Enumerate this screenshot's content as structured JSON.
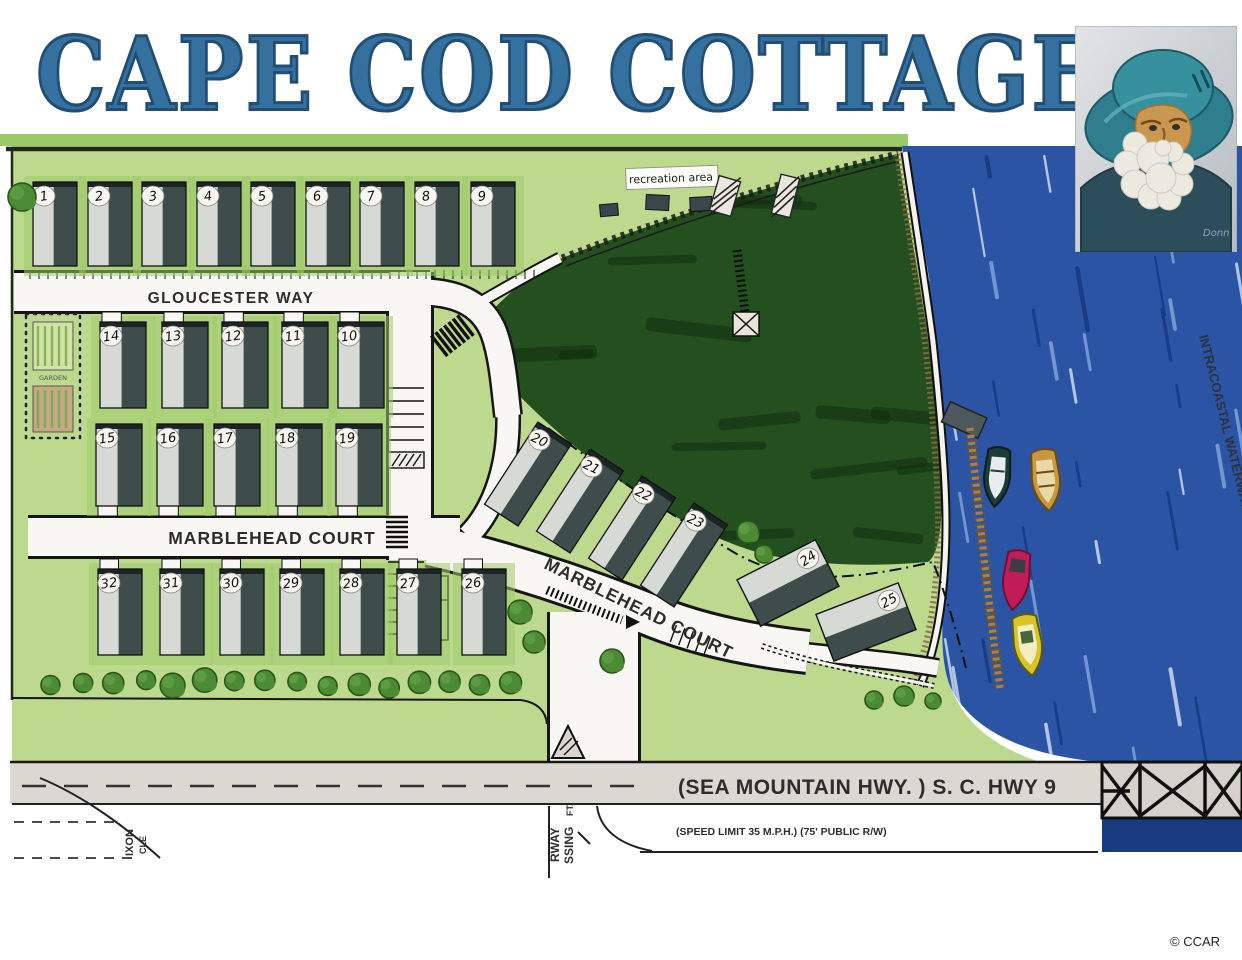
{
  "title": "CAPE COD COTTAGES",
  "credit": "© CCAR",
  "painting": {
    "signature": "Donn"
  },
  "map": {
    "labels": {
      "recreation": "recreation area",
      "gloucester": "GLOUCESTER WAY",
      "marblehead_h": "MARBLEHEAD COURT",
      "marblehead_d": "MARBLEHEAD COURT",
      "highway": "(SEA MOUNTAIN HWY. )   S. C. HWY 9",
      "speed": "(SPEED LIMIT 35 M.P.H.) (75' PUBLIC R/W)",
      "waterway": "INTRACOASTAL WATERWAY",
      "garden": "GARDEN",
      "street_left_a": "IXON",
      "street_left_b": "CLE",
      "entrance_a": "RWAY",
      "entrance_b": "SSING",
      "entrance_c": "FT."
    },
    "colors": {
      "title_blue": "#34719f",
      "site_green": "#bdd98e",
      "stripe_green": "#9fcb6c",
      "border_green": "#9cc968",
      "marsh_green": "#24501f",
      "marsh_dark": "#112e0e",
      "water_blue": "#2b54a4",
      "water_light": "#7fa2d8",
      "water_white": "#ccd8ee",
      "water_dark": "#173a80",
      "road_white": "#f8f7f3",
      "highway_gray": "#dbd8d1",
      "lot_light": "#d7d9d5",
      "lot_dark": "#3e4c4c",
      "tree_green": "#4c8a33",
      "dock_brown": "#a5814f",
      "boat_dark": "#1d3b38",
      "boat_tan": "#c9973f",
      "boat_red": "#c01d56",
      "boat_yellow": "#d9c428"
    },
    "lot_rows": [
      {
        "y": 182,
        "h": 84,
        "w": 44,
        "stub": "none",
        "ticks": true,
        "items": [
          {
            "n": "1",
            "x": 33
          },
          {
            "n": "2",
            "x": 88
          },
          {
            "n": "3",
            "x": 142
          },
          {
            "n": "4",
            "x": 197
          },
          {
            "n": "5",
            "x": 251
          },
          {
            "n": "6",
            "x": 306
          },
          {
            "n": "7",
            "x": 360
          },
          {
            "n": "8",
            "x": 415
          },
          {
            "n": "9",
            "x": 471
          }
        ]
      },
      {
        "y": 322,
        "h": 86,
        "w": 46,
        "stub": "top",
        "ticks": false,
        "items": [
          {
            "n": "14",
            "x": 100
          },
          {
            "n": "13",
            "x": 162
          },
          {
            "n": "12",
            "x": 222
          },
          {
            "n": "11",
            "x": 282
          },
          {
            "n": "10",
            "x": 338
          }
        ]
      },
      {
        "y": 424,
        "h": 82,
        "w": 46,
        "stub": "bottom",
        "ticks": false,
        "items": [
          {
            "n": "15",
            "x": 96
          },
          {
            "n": "16",
            "x": 157
          },
          {
            "n": "17",
            "x": 214
          },
          {
            "n": "18",
            "x": 276
          },
          {
            "n": "19",
            "x": 336
          }
        ]
      },
      {
        "y": 569,
        "h": 86,
        "w": 44,
        "stub": "top",
        "ticks": false,
        "items": [
          {
            "n": "32",
            "x": 98
          },
          {
            "n": "31",
            "x": 160
          },
          {
            "n": "30",
            "x": 220
          },
          {
            "n": "29",
            "x": 280
          },
          {
            "n": "28",
            "x": 340
          },
          {
            "n": "27",
            "x": 397
          },
          {
            "n": "26",
            "x": 462
          }
        ]
      }
    ],
    "lot_diag": [
      {
        "n": "20",
        "cx": 528,
        "cy": 474,
        "w": 40,
        "h": 98,
        "a": 33,
        "wide": false
      },
      {
        "n": "21",
        "cx": 580,
        "cy": 501,
        "w": 40,
        "h": 98,
        "a": 33,
        "wide": false
      },
      {
        "n": "22",
        "cx": 632,
        "cy": 528,
        "w": 40,
        "h": 98,
        "a": 33,
        "wide": false
      },
      {
        "n": "23",
        "cx": 684,
        "cy": 555,
        "w": 40,
        "h": 98,
        "a": 33,
        "wide": false
      },
      {
        "n": "24",
        "cx": 788,
        "cy": 583,
        "w": 88,
        "h": 52,
        "a": -27,
        "wide": true
      },
      {
        "n": "25",
        "cx": 866,
        "cy": 622,
        "w": 88,
        "h": 50,
        "a": -21,
        "wide": true
      }
    ]
  }
}
